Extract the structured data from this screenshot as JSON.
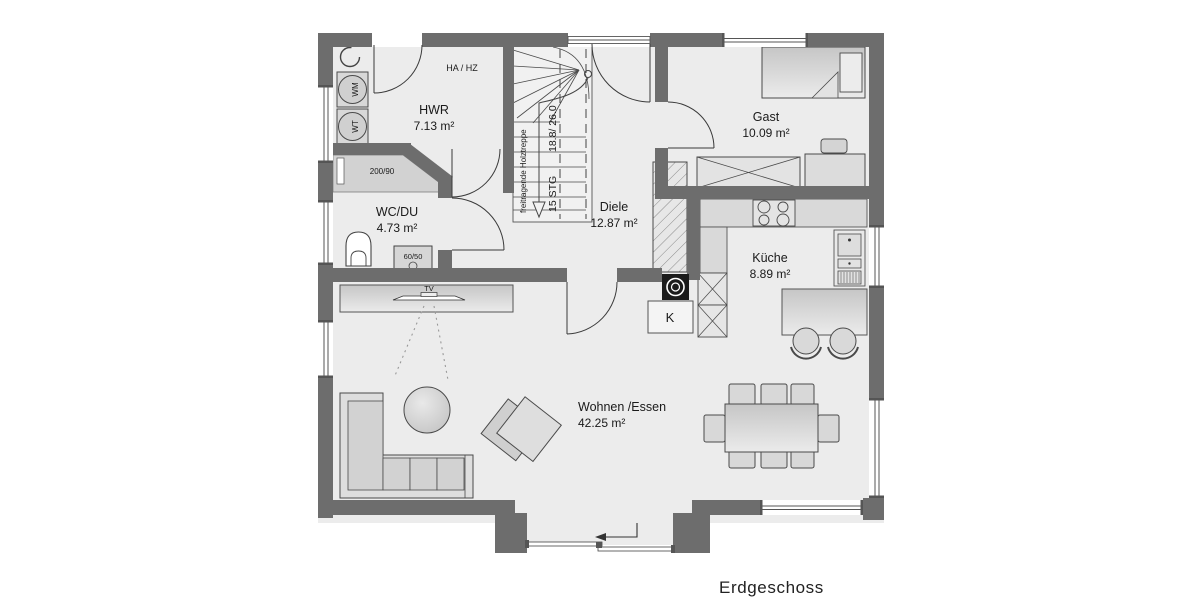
{
  "title": "Erdgeschoss",
  "rooms": {
    "hwr": {
      "name": "HWR",
      "area": "7.13 m²"
    },
    "wc_du": {
      "name": "WC/DU",
      "area": "4.73 m²"
    },
    "diele": {
      "name": "Diele",
      "area": "12.87 m²"
    },
    "gast": {
      "name": "Gast",
      "area": "10.09 m²"
    },
    "kueche": {
      "name": "Küche",
      "area": "8.89 m²"
    },
    "wohnen_essen": {
      "name": "Wohnen /Essen",
      "area": "42.25 m²"
    }
  },
  "labels": {
    "ha_hz": "HA / HZ",
    "washing_machine": "WM",
    "dryer": "WT",
    "shower_size": "200/90",
    "basin_size": "60/50",
    "tv": "TV",
    "chimney": "K",
    "stair_type": "freitragende Holztreppe",
    "stair_count": "15 STG",
    "stair_dim": "18.8/ 26.0"
  },
  "colors": {
    "wall": "#6d6d6d",
    "floor": "#ececec",
    "furniture": "#d8d8d8",
    "line": "#444444"
  }
}
